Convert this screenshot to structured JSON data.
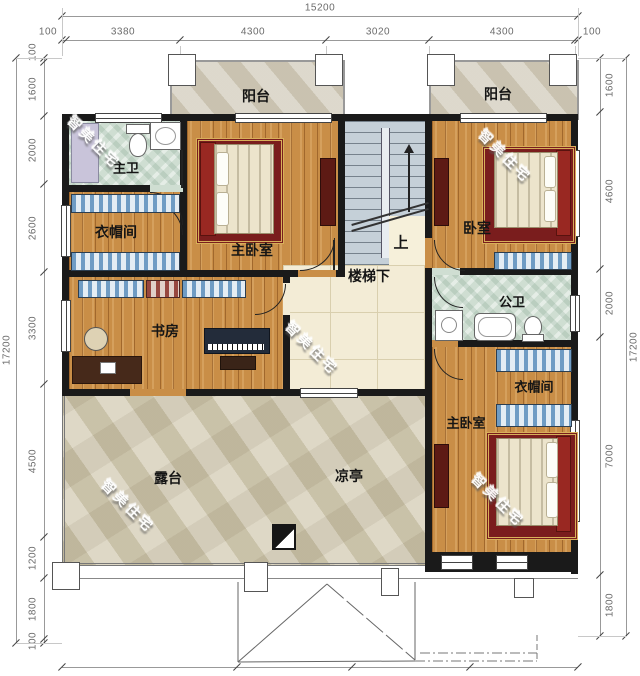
{
  "watermark": "智美住宅",
  "rooms": {
    "balcony": "阳台",
    "master_bath": "主卫",
    "closet": "衣帽间",
    "master_bedroom": "主卧室",
    "bedroom": "卧室",
    "under_stairs": "楼梯下",
    "up": "上",
    "shared_bath": "公卫",
    "study": "书房",
    "terrace": "露台",
    "pavilion": "凉亭"
  },
  "dims": {
    "top_total": "15200",
    "top": [
      "100",
      "3380",
      "4300",
      "3020",
      "4300",
      "100"
    ],
    "left_total": "17200",
    "left": [
      "100",
      "1600",
      "2000",
      "2600",
      "3300",
      "4500",
      "1200",
      "1800",
      "100"
    ],
    "right_total": "17200",
    "right": [
      "1600",
      "4600",
      "2000",
      "7000",
      "1800"
    ]
  },
  "colors": {
    "wall": "#1a1a1a",
    "wood": "#c98e47",
    "tile": "#cfded2",
    "stone": "#d7d0b9"
  }
}
